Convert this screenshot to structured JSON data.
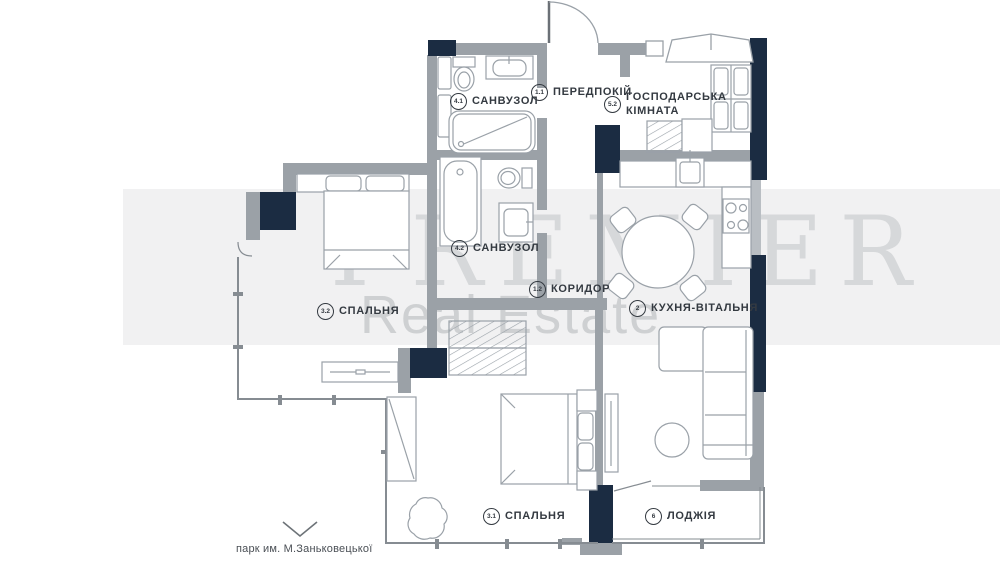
{
  "plan": {
    "rooms": [
      {
        "number": "4.1",
        "name": "САНВУЗОЛ"
      },
      {
        "number": "1.1",
        "name": "ПЕРЕДПОКІЙ"
      },
      {
        "number": "5.2",
        "name": "ГОСПОДАРСЬКА\nКІМНАТА"
      },
      {
        "number": "4.2",
        "name": "САНВУЗОЛ"
      },
      {
        "number": "1.2",
        "name": "КОРИДОР"
      },
      {
        "number": "3.2",
        "name": "СПАЛЬНЯ"
      },
      {
        "number": "2",
        "name": "КУХНЯ-ВІТАЛЬНЯ"
      },
      {
        "number": "3.1",
        "name": "СПАЛЬНЯ"
      },
      {
        "number": "6",
        "name": "ЛОДЖІЯ"
      }
    ],
    "annotation": {
      "park": "парк им. М.Заньковецької"
    },
    "watermark": {
      "line1": "PREMIER",
      "line2": "Real Estate"
    },
    "colors": {
      "wall": "#9aa1a8",
      "accent": "#1b2c42",
      "window_line": "#868c92"
    }
  }
}
